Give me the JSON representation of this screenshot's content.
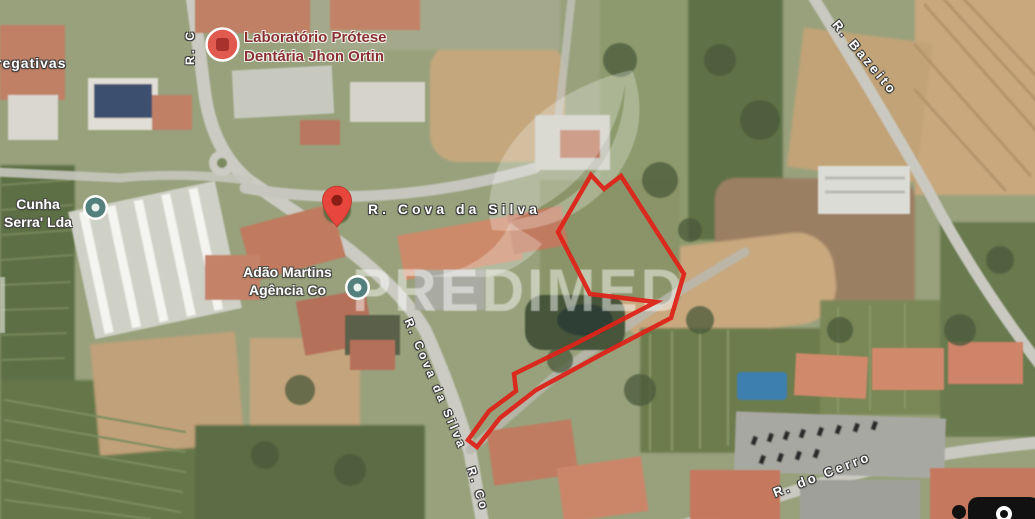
{
  "map": {
    "watermark": {
      "brand": "PREDIMED"
    },
    "property_boundary": {
      "color": "#dd2419",
      "points": [
        [
          558,
          232
        ],
        [
          591,
          175
        ],
        [
          604,
          189
        ],
        [
          621,
          176
        ],
        [
          684,
          274
        ],
        [
          671,
          318
        ],
        [
          604,
          353
        ],
        [
          536,
          390
        ],
        [
          500,
          418
        ],
        [
          477,
          447
        ],
        [
          468,
          440
        ],
        [
          489,
          411
        ],
        [
          516,
          391
        ],
        [
          514,
          374
        ],
        [
          571,
          346
        ],
        [
          656,
          302
        ],
        [
          590,
          294
        ]
      ]
    },
    "streets": {
      "bazeito": "R. Bazeito",
      "cova_horizontal": "R. Cova da Silva",
      "cova_diagonal": "R. Cova da Silva",
      "cova_diagonal_2": "R. Co",
      "cerro": "R. do Cerro",
      "top_left_partial": "R. C",
      "left_edge_partial": "regativas"
    },
    "pois": {
      "laboratorio": {
        "line1": "Laboratório Prótese",
        "line2": "Dentária Jhon Ortin"
      },
      "cunha": {
        "line1": "Cunha",
        "line2": "Serra' Lda"
      },
      "martins": {
        "line1": "Adão Martins",
        "line2": "Agência Co"
      }
    }
  }
}
